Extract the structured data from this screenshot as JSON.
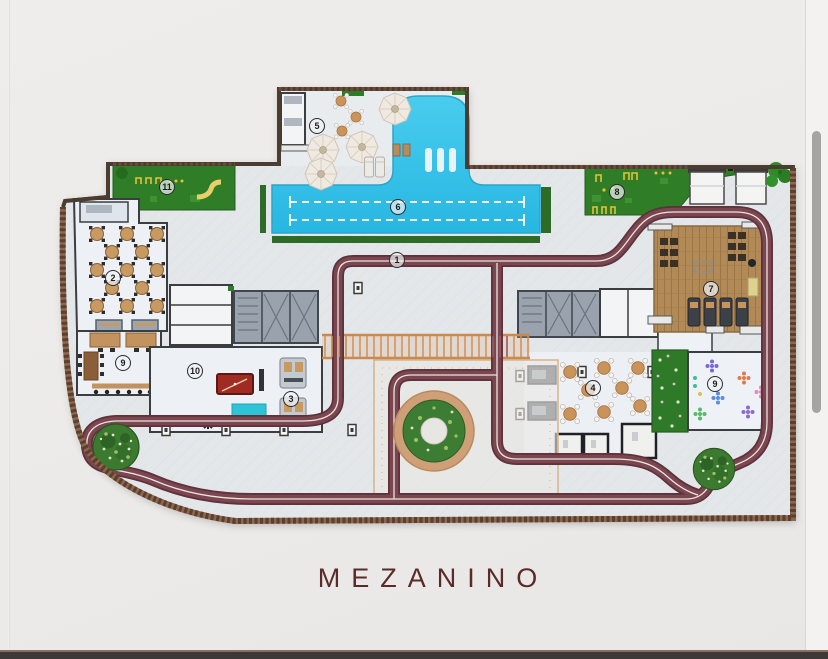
{
  "title": {
    "text": "MEZANINO"
  },
  "plan": {
    "labels": [
      {
        "n": "1",
        "x": 397,
        "y": 260
      },
      {
        "n": "2",
        "x": 113,
        "y": 278
      },
      {
        "n": "3",
        "x": 291,
        "y": 399
      },
      {
        "n": "4",
        "x": 593,
        "y": 388
      },
      {
        "n": "5",
        "x": 317,
        "y": 126
      },
      {
        "n": "6",
        "x": 398,
        "y": 207
      },
      {
        "n": "7",
        "x": 711,
        "y": 289
      },
      {
        "n": "8",
        "x": 617,
        "y": 192
      },
      {
        "n": "9",
        "x": 123,
        "y": 363
      },
      {
        "n": "9",
        "x": 715,
        "y": 384
      },
      {
        "n": "10",
        "x": 195,
        "y": 371
      },
      {
        "n": "11",
        "x": 167,
        "y": 187
      }
    ],
    "colors": {
      "running_track": "#6e3c44",
      "pool": "#35c3e8",
      "lawn": "#2f7d26",
      "wood_deck": "#b28a58",
      "deck": "#e5e7ea",
      "boundary_wall": "#6f4b37",
      "title_text": "#5a2b28",
      "scrollbar_thumb": "#a5a4a3",
      "bottom_bar": "#3b3a39"
    }
  }
}
